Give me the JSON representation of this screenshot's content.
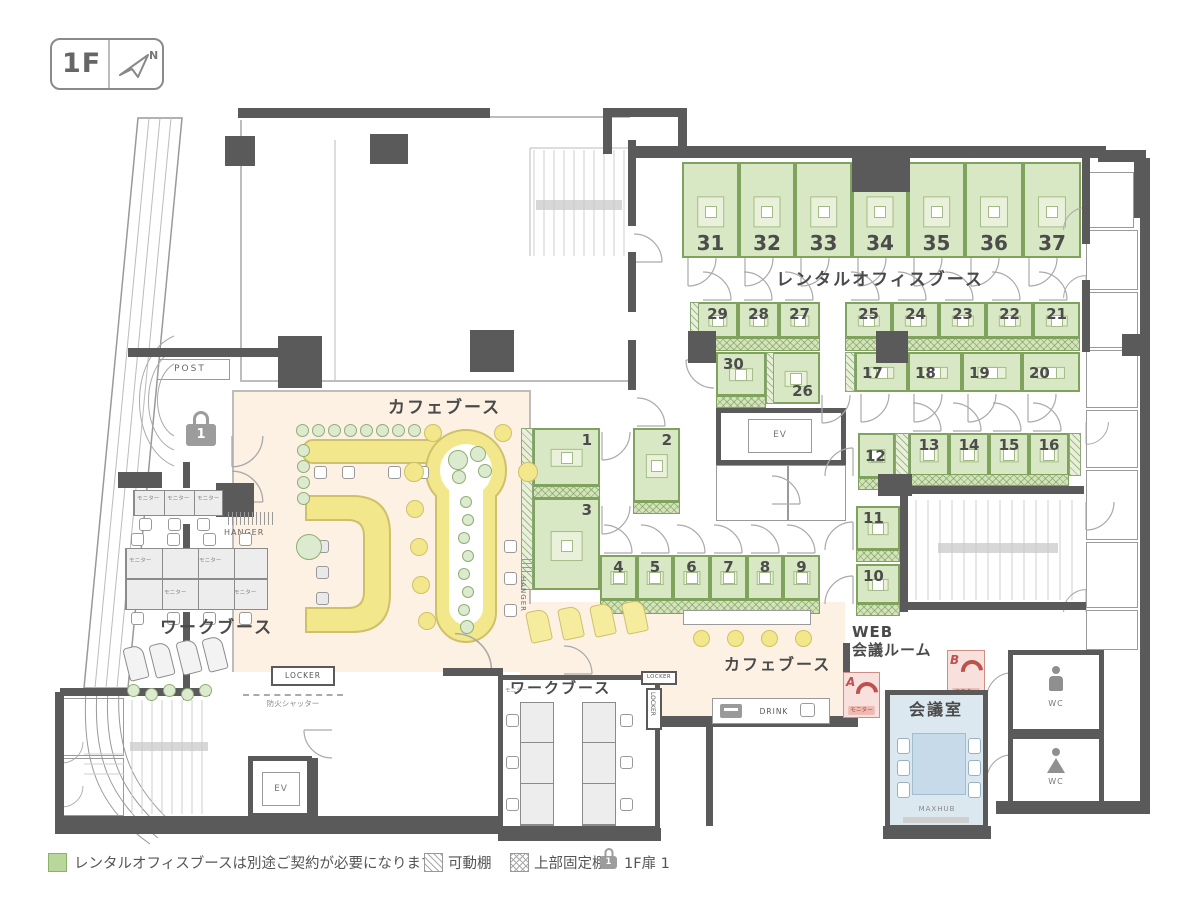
{
  "badge": {
    "floor": "1F",
    "north_label": "N"
  },
  "area_labels": {
    "rental_office_booth": "レンタルオフィスブース",
    "cafe_booth_1": "カフェブース",
    "cafe_booth_2": "カフェブース",
    "work_booth_1": "ワークブース",
    "work_booth_2": "ワークブース",
    "web_meeting_room_line1": "WEB",
    "web_meeting_room_line2": "会議ルーム",
    "meeting_room": "会議室"
  },
  "booths": [
    "1",
    "2",
    "3",
    "4",
    "5",
    "6",
    "7",
    "8",
    "9",
    "10",
    "11",
    "12",
    "13",
    "14",
    "15",
    "16",
    "17",
    "18",
    "19",
    "20",
    "21",
    "22",
    "23",
    "24",
    "25",
    "26",
    "27",
    "28",
    "29",
    "30",
    "31",
    "32",
    "33",
    "34",
    "35",
    "36",
    "37"
  ],
  "labels": {
    "post": "POST",
    "ev": "EV",
    "wc": "WC",
    "hanger": "HANGER",
    "locker": "LOCKER",
    "monitor": "モニター",
    "drink": "DRINK",
    "maxhub": "MAXHUB",
    "fire_shutter": "防火シャッター",
    "phone_booth_a": "A",
    "phone_booth_b": "B",
    "door_lock_number": "1"
  },
  "legend": {
    "rental_note": "レンタルオフィスブースは別途ご契約が必要になります。",
    "movable_shelf": "可動棚",
    "upper_fixed_shelf": "上部固定棚",
    "door_1f": "1F扉 1"
  },
  "colors": {
    "booth_green": "#d8e8c4",
    "booth_border": "#7fa25c",
    "cafe_cream": "#fcf1e3",
    "counter_yellow": "#f3e78c",
    "meeting_blue": "#dce8f0",
    "phone_pink": "#f8e1dd",
    "wall_gray": "#5a5a5a",
    "legend_green": "#b7d79b"
  }
}
